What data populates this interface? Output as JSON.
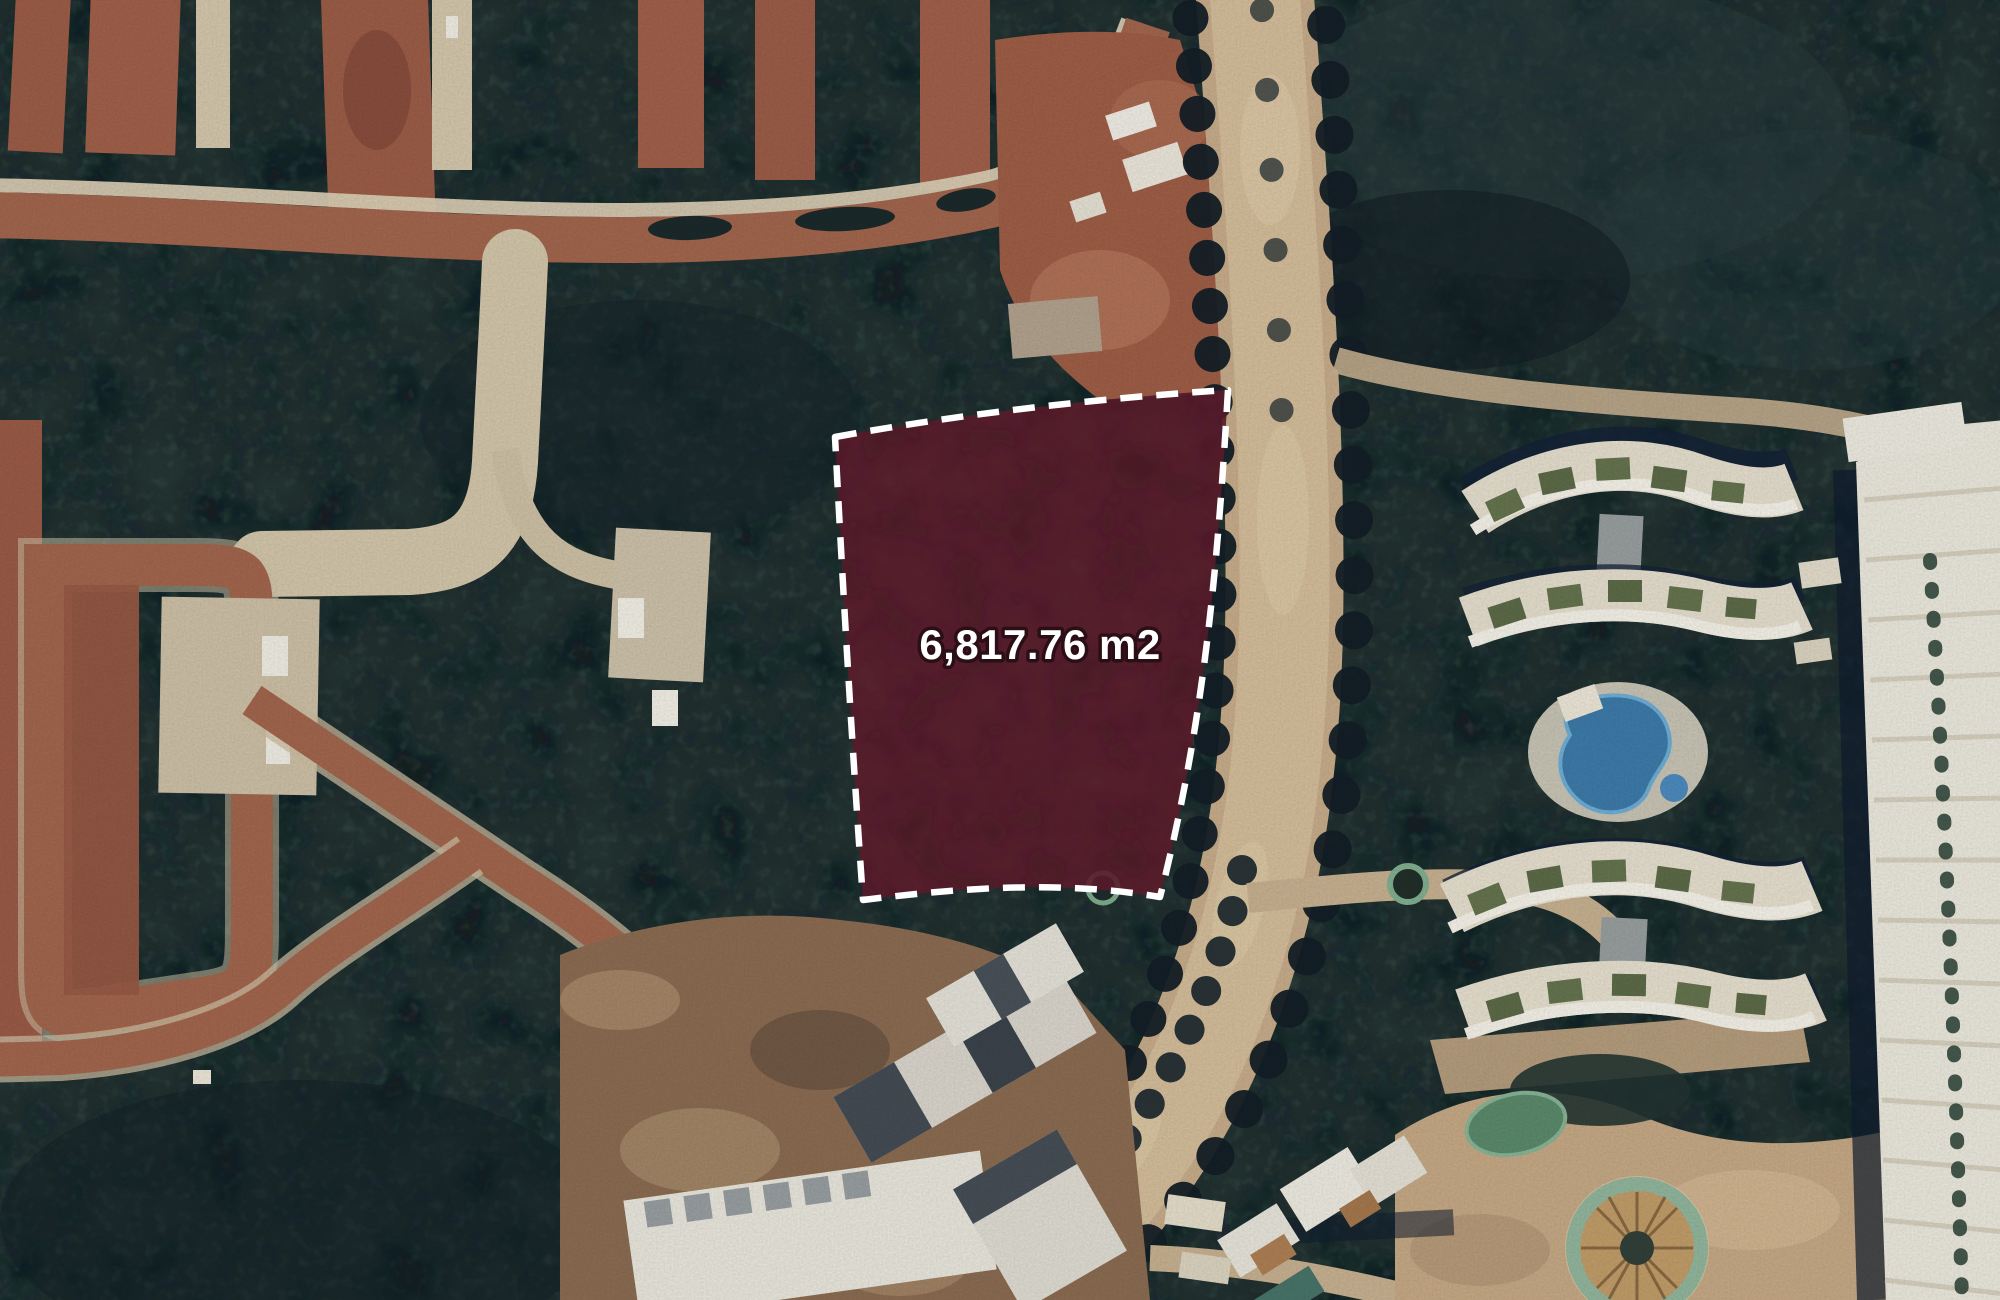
{
  "window": {
    "width": 2000,
    "height": 1300
  },
  "map": {
    "view": "satellite-imagery",
    "parcel": {
      "area_label": "6,817.76 m2",
      "fill_color": "#5e1f2d",
      "fill_opacity": "0.88",
      "outline_color": "#ffffff",
      "outline_style": "dashed"
    },
    "palette": {
      "forest_base": "#253635",
      "forest_shadow": "#0a161b",
      "forest_light": "#4a655b",
      "lot_red": "#9d5e48",
      "road_cream": "#d5c8ac",
      "road_tan": "#c9ae8c",
      "building_white": "#eeebe0",
      "building_shadow_navy": "#132238",
      "pool_blue": "#3e7cab",
      "pond_green": "#5c8b6d",
      "palapa_tan": "#c39e6a"
    },
    "features": [
      {
        "name": "jungle-forest"
      },
      {
        "name": "residential-lot-streets-west"
      },
      {
        "name": "boulevard-with-tree-median"
      },
      {
        "name": "land-parcel-overlay"
      },
      {
        "name": "construction-site-south"
      },
      {
        "name": "resort-curved-buildings-east"
      },
      {
        "name": "kidney-swimming-pool"
      },
      {
        "name": "garden-pond"
      },
      {
        "name": "palapa-roundabout"
      },
      {
        "name": "resort-main-building-east"
      }
    ]
  }
}
